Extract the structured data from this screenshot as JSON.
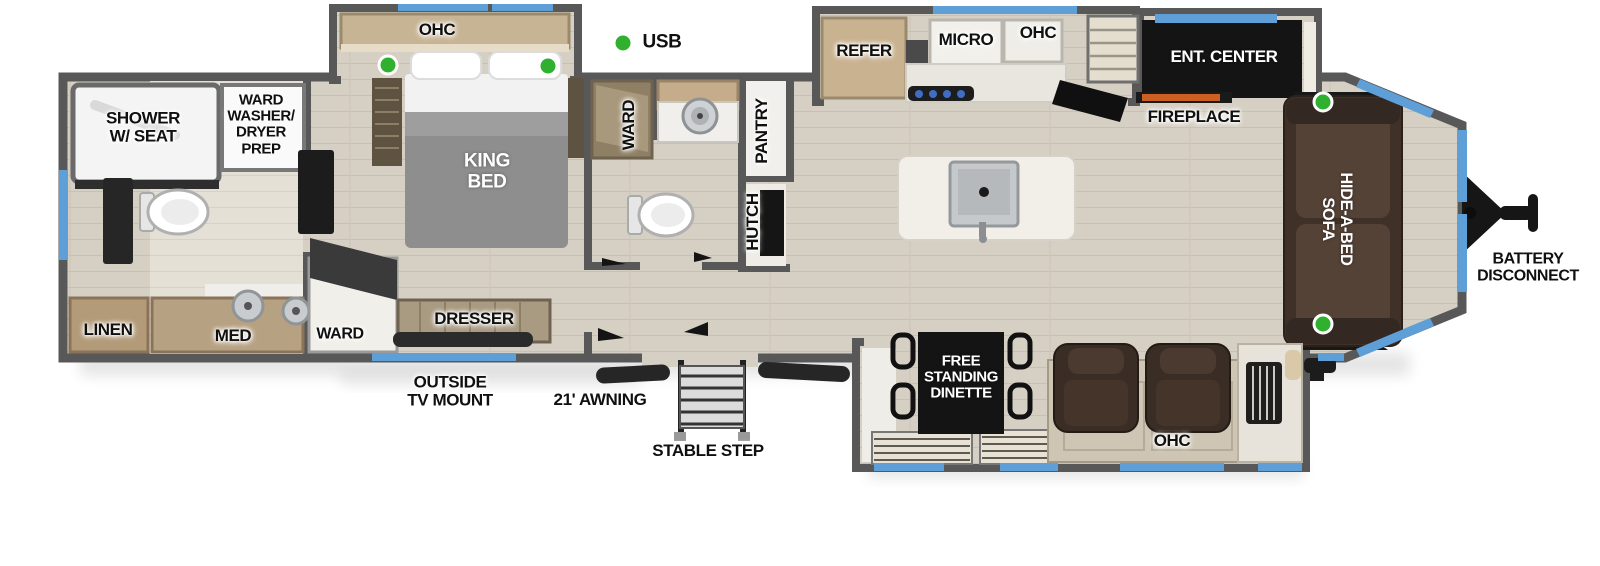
{
  "title": "travel-trailer-floorplan",
  "colors": {
    "wall": "#585858",
    "floor": "#d6cfc3",
    "window_accent": "#5f9fd8",
    "usb_indicator": "#2fb02f",
    "sofa_brown": "#3f3128",
    "wood_cabinet": "#c9b290"
  },
  "legend": {
    "usb": "USB"
  },
  "labels": {
    "shower": "SHOWER\nW/ SEAT",
    "washer_dryer": "WARD\nWASHER/\nDRYER\nPREP",
    "linen": "LINEN",
    "med": "MED",
    "ward_bedroom": "WARD",
    "ohc_bedroom": "OHC",
    "king_bed": "KING\nBED",
    "dresser": "DRESSER",
    "ward_bath": "WARD",
    "pantry": "PANTRY",
    "hutch": "HUTCH",
    "usb": "USB",
    "refer": "REFER",
    "micro": "MICRO",
    "ohc_kitchen": "OHC",
    "ent_center": "ENT. CENTER",
    "fireplace": "FIREPLACE",
    "hide_a_bed_sofa": "HIDE-A-BED\nSOFA",
    "battery_disconnect": "BATTERY\nDISCONNECT",
    "free_standing_dinette": "FREE\nSTANDING\nDINETTE",
    "ohc_living": "OHC",
    "outside_tv_mount": "OUTSIDE\nTV MOUNT",
    "awning": "21' AWNING",
    "stable_step": "STABLE STEP"
  }
}
